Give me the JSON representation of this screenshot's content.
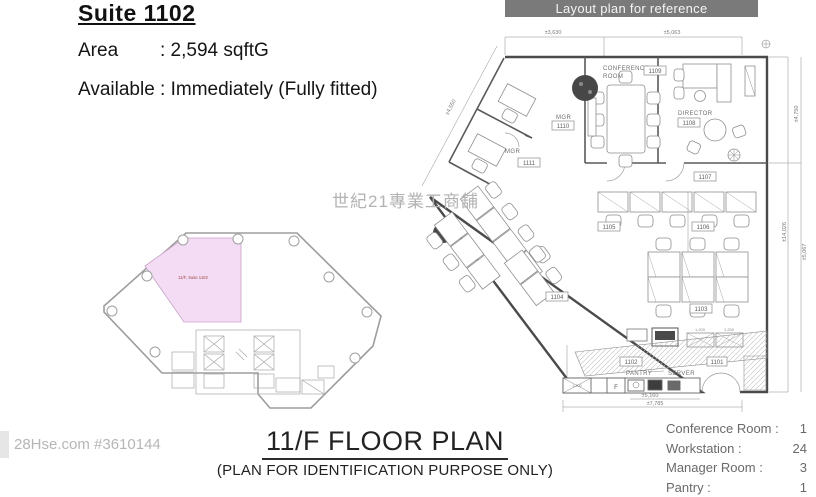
{
  "listing": {
    "title": "Suite 1102",
    "area_label": "Area",
    "area_value": ": 2,594 sqftG",
    "available_line": "Available : Immediately (Fully fitted)"
  },
  "banner": {
    "text": "Layout plan for reference"
  },
  "floor_plan": {
    "rooms": {
      "conference_line1": "CONFERENCE",
      "conference_line2": "ROOM",
      "conference_id": "1109",
      "director_label": "DIRECTOR",
      "director_id": "1108",
      "mgr1_label": "MGR",
      "mgr1_id": "1110",
      "mgr2_label": "MGR",
      "mgr2_id": "1111",
      "zone_1107": "1107",
      "zone_1105": "1105",
      "zone_1106": "1106",
      "zone_1104": "1104",
      "zone_1103": "1103",
      "zone_1102": "1102",
      "zone_1101": "1101",
      "pantry_label": "PANTRY",
      "server_label": "SERVER",
      "fridge_label": "F"
    },
    "dimensions": {
      "top_left": "±3,630",
      "top_right": "±5,063",
      "diag": "±4,550",
      "right_upper": "±4,750",
      "right_full": "±14,026",
      "right_lower": "±5,067",
      "bottom_inner": "±5,160",
      "bottom_outer": "±7,785",
      "cabinet_a": "1,200",
      "cabinet_b": "1,200",
      "counter": "1,200"
    }
  },
  "key_plan": {
    "highlight_label": "11/F, Suite 1102"
  },
  "footer": {
    "title": "11/F FLOOR PLAN",
    "subtitle": "(PLAN FOR IDENTIFICATION PURPOSE ONLY)"
  },
  "watermarks": {
    "listing_id": "28Hse.com #3610144",
    "agency": "世紀21專業工商舖"
  },
  "legend": {
    "rows": [
      {
        "label": "Conference Room :",
        "value": "1"
      },
      {
        "label": "Workstation :",
        "value": "24"
      },
      {
        "label": "Manager Room :",
        "value": "3"
      },
      {
        "label": "Pantry :",
        "value": "1"
      }
    ]
  }
}
